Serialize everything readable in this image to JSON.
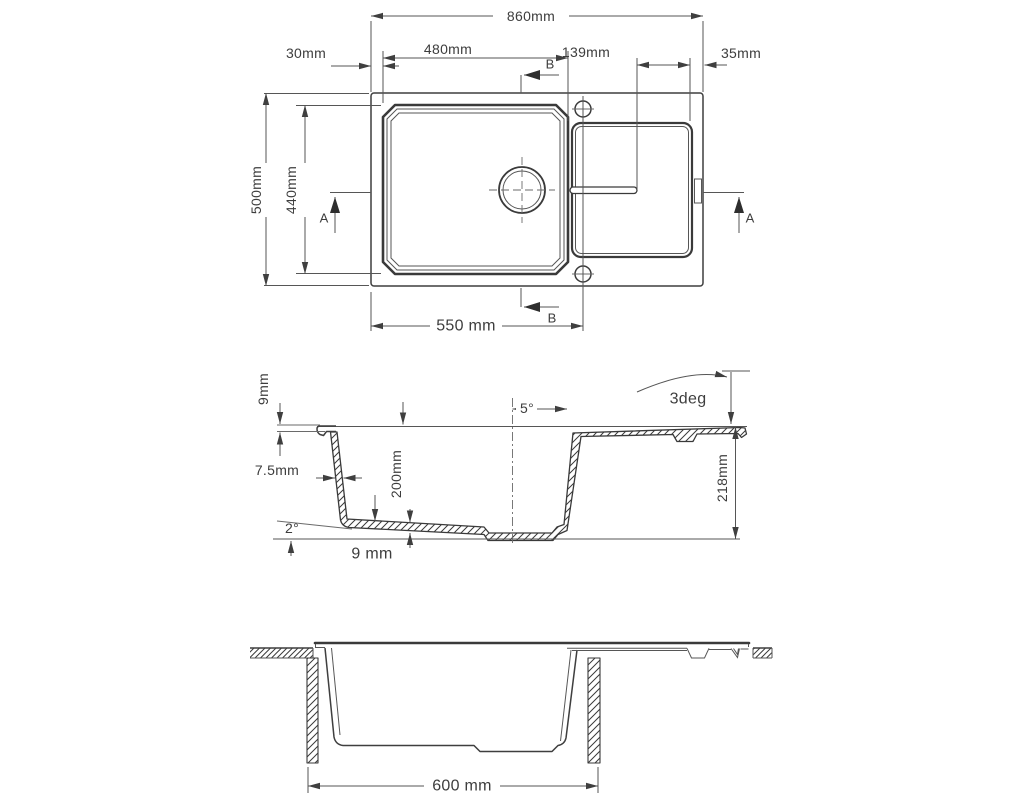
{
  "title": "Kitchen sink technical drawing - three orthographic views",
  "colors": {
    "outline": "#3a3a3a",
    "dimension_line": "#565656",
    "text": "#3d3d3d",
    "background": "#ffffff"
  },
  "plan_view": {
    "overall_width": "860mm",
    "left_margin": "30mm",
    "bowl_width": "480mm",
    "drainer_length": "139mm",
    "right_margin": "35mm",
    "overall_depth": "500mm",
    "bowl_length": "440mm",
    "tap_offset": "550 mm",
    "section_a": "A",
    "section_b": "B"
  },
  "section_view": {
    "rim_thickness": "9mm",
    "wall_thickness": "7.5mm",
    "bowl_depth": "200mm",
    "base_thickness": "9 mm",
    "base_angle": "2°",
    "wall_angle": "5°",
    "drainer_angle": "3deg",
    "overall_height": "218mm"
  },
  "installation_view": {
    "cabinet_width": "600 mm"
  }
}
